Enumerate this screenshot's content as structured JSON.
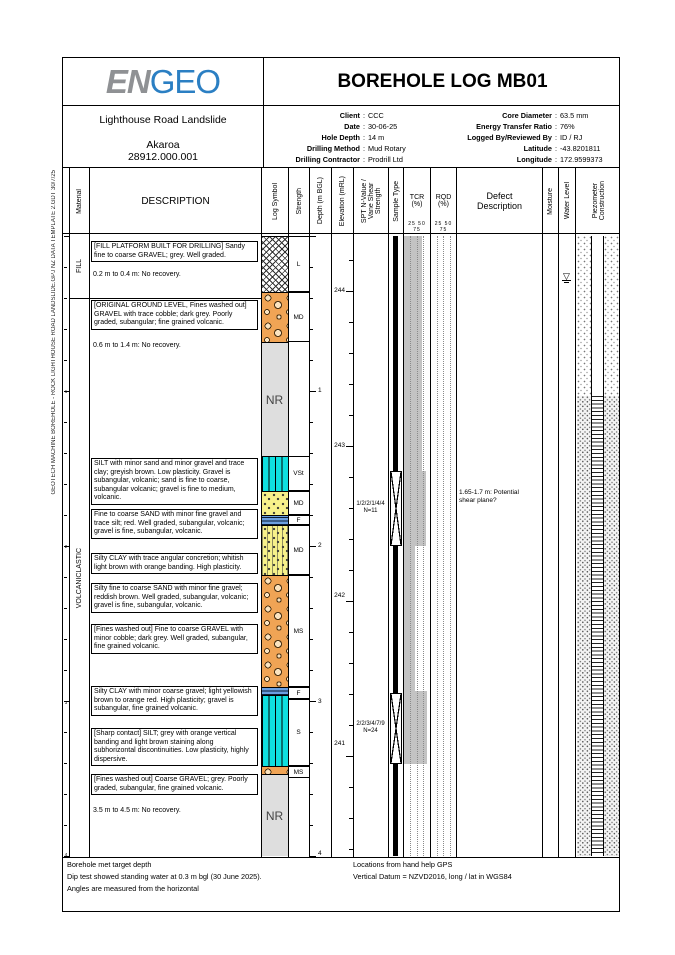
{
  "side_text": "GEOTECH MACHINE BOREHOLE - ROCK  LIGHTHOUSE ROAD LANDSLIDE.GPJ  NZ DATA TEMPLATE 2.GDT  30/7/25",
  "header": {
    "logo_part1": "EN",
    "logo_part2": "GEO",
    "title": "BOREHOLE LOG MB01",
    "project_name": "Lighthouse Road Landslide",
    "project_location": "Akaroa",
    "project_number": "28912.000.001",
    "info_left": [
      {
        "label": "Client",
        "value": "CCC"
      },
      {
        "label": "Date",
        "value": "30-06-25"
      },
      {
        "label": "Hole Depth",
        "value": "14 m"
      },
      {
        "label": "Drilling Method",
        "value": "Mud Rotary"
      },
      {
        "label": "Drilling Contractor",
        "value": "Prodrill Ltd"
      }
    ],
    "info_right": [
      {
        "label": "Core Diameter",
        "value": "63.5 mm"
      },
      {
        "label": "Energy Transfer Ratio",
        "value": "76%"
      },
      {
        "label": "Logged By/Reviewed By",
        "value": "ID / RJ"
      },
      {
        "label": "Latitude",
        "value": "-43.8201811"
      },
      {
        "label": "Longitude",
        "value": "172.9599373"
      }
    ]
  },
  "columns": [
    {
      "key": "ruler",
      "x": 0,
      "w": 6,
      "label": "",
      "vert": false
    },
    {
      "key": "material",
      "x": 6,
      "w": 20,
      "label": "Material",
      "vert": true
    },
    {
      "key": "description",
      "x": 26,
      "w": 172,
      "label": "DESCRIPTION",
      "vert": false,
      "big": true
    },
    {
      "key": "log-symbol",
      "x": 198,
      "w": 27,
      "label": "Log Symbol",
      "vert": true
    },
    {
      "key": "strength",
      "x": 225,
      "w": 21,
      "label": "Strength",
      "vert": true
    },
    {
      "key": "depth",
      "x": 246,
      "w": 22,
      "label": "Depth (m BGL)",
      "vert": true
    },
    {
      "key": "elevation",
      "x": 268,
      "w": 22,
      "label": "Elevation (mRL)",
      "vert": true
    },
    {
      "key": "spt",
      "x": 290,
      "w": 35,
      "label": "SPT N-Value /\nVane Shear\nStrength",
      "vert": true
    },
    {
      "key": "sample-type",
      "x": 325,
      "w": 15,
      "label": "Sample Type",
      "vert": true
    },
    {
      "key": "tcr",
      "x": 340,
      "w": 27,
      "label": "TCR\n(%)",
      "vert": false,
      "scale": true
    },
    {
      "key": "rqd",
      "x": 367,
      "w": 26,
      "label": "RQD\n(%)",
      "vert": false,
      "scale": true
    },
    {
      "key": "defect",
      "x": 393,
      "w": 86,
      "label": "Defect\nDescription",
      "vert": false,
      "big": true
    },
    {
      "key": "moisture",
      "x": 479,
      "w": 16,
      "label": "Moisture",
      "vert": true
    },
    {
      "key": "water-level",
      "x": 495,
      "w": 17,
      "label": "Water Level",
      "vert": true
    },
    {
      "key": "piezometer",
      "x": 512,
      "w": 46,
      "label": "Piezometer\nConstruction",
      "vert": true
    }
  ],
  "scale_ticks": "25 50 75",
  "log": {
    "materials": [
      {
        "label": "FILL",
        "top": 0,
        "height": 64
      },
      {
        "label": "VOLCANICLASTIC",
        "top": 64,
        "height": 560
      }
    ],
    "material_divider_y": 64,
    "descriptions": [
      {
        "top": 7,
        "boxed": true,
        "text": "[FILL PLATFORM BUILT FOR DRILLING] Sandy fine to coarse GRAVEL; grey. Well graded."
      },
      {
        "top": 36,
        "boxed": false,
        "text": "0.2 m to 0.4 m: No recovery."
      },
      {
        "top": 66,
        "boxed": true,
        "text": "[ORIGINAL GROUND LEVEL, Fines washed out] GRAVEL with trace cobble; dark grey. Poorly graded, subangular; fine grained volcanic."
      },
      {
        "top": 107,
        "boxed": false,
        "text": "0.6 m to 1.4 m: No recovery."
      },
      {
        "top": 224,
        "boxed": true,
        "text": "SILT with minor sand and minor gravel and trace clay; greyish brown. Low plasticity. Gravel is subangular, volcanic; sand is fine to coarse, subangular volcanic; gravel is fine to medium, volcanic."
      },
      {
        "top": 275,
        "boxed": true,
        "text": "Fine to coarse SAND with minor fine gravel and trace silt; red. Well graded, subangular, volcanic; gravel is fine, subangular, volcanic."
      },
      {
        "top": 319,
        "boxed": true,
        "text": "Silty CLAY with trace angular concretion; whitish light brown with orange banding. High plasticity."
      },
      {
        "top": 349,
        "boxed": true,
        "text": "Silty fine to coarse SAND with minor fine gravel; reddish brown. Well graded, subangular, volcanic; gravel is fine, subangular, volcanic."
      },
      {
        "top": 390,
        "boxed": true,
        "text": "[Fines washed out] Fine to coarse GRAVEL with minor cobble; dark grey. Well graded, subangular, fine grained volcanic."
      },
      {
        "top": 452,
        "boxed": true,
        "text": "Silty CLAY with minor coarse gravel; light yellowish brown to orange red. High plasticity; gravel is subangular, fine grained volcanic."
      },
      {
        "top": 494,
        "boxed": true,
        "text": "[Sharp contact] SILT; grey with orange vertical banding and light brown staining along subhorizontal discontinuities. Low plasticity, highly dispersive."
      },
      {
        "top": 540,
        "boxed": true,
        "text": "[Fines washed out] Coarse GRAVEL; grey. Poorly graded, subangular, fine grained volcanic."
      },
      {
        "top": 572,
        "boxed": false,
        "text": "3.5 m to 4.5 m: No recovery."
      }
    ],
    "segments": [
      {
        "top": 2,
        "h": 56,
        "pattern": "hatch"
      },
      {
        "top": 58,
        "h": 50,
        "pattern": "gravel"
      },
      {
        "top": 108,
        "h": 114,
        "pattern": "nr",
        "label": "NR"
      },
      {
        "top": 222,
        "h": 35,
        "pattern": "silt"
      },
      {
        "top": 257,
        "h": 24,
        "pattern": "sand"
      },
      {
        "top": 281,
        "h": 10,
        "pattern": "clay"
      },
      {
        "top": 291,
        "h": 50,
        "pattern": "sand-silty"
      },
      {
        "top": 341,
        "h": 112,
        "pattern": "gravel"
      },
      {
        "top": 453,
        "h": 8,
        "pattern": "clay"
      },
      {
        "top": 461,
        "h": 71,
        "pattern": "silt"
      },
      {
        "top": 532,
        "h": 8,
        "pattern": "gravel"
      },
      {
        "top": 540,
        "h": 82,
        "pattern": "nr",
        "label": "NR"
      }
    ],
    "strength_cells": [
      {
        "top": 2,
        "h": 56,
        "label": "L"
      },
      {
        "top": 58,
        "h": 50,
        "label": "MD"
      },
      {
        "top": 222,
        "h": 35,
        "label": "VSt"
      },
      {
        "top": 257,
        "h": 24,
        "label": "MD"
      },
      {
        "top": 281,
        "h": 10,
        "label": "F"
      },
      {
        "top": 291,
        "h": 50,
        "label": "MD"
      },
      {
        "top": 341,
        "h": 112,
        "label": "MS"
      },
      {
        "top": 453,
        "h": 12,
        "label": "F"
      },
      {
        "top": 465,
        "h": 67,
        "label": "S"
      },
      {
        "top": 532,
        "h": 12,
        "label": "MS"
      }
    ],
    "depth_labels": [
      {
        "value": "1",
        "y": 157
      },
      {
        "value": "2",
        "y": 312
      },
      {
        "value": "3",
        "y": 468
      },
      {
        "value": "4",
        "y": 620
      }
    ],
    "elev_labels": [
      {
        "value": "244",
        "y": 57
      },
      {
        "value": "243",
        "y": 212
      },
      {
        "value": "242",
        "y": 362
      },
      {
        "value": "241",
        "y": 510
      }
    ],
    "spt_tests": [
      {
        "top": 237,
        "h": 75,
        "blows": "1/2/2/1/4/4",
        "n": "N=11"
      },
      {
        "top": 459,
        "h": 71,
        "blows": "2/2/3/4/7/9",
        "n": "N=24"
      }
    ],
    "sample_bar": {
      "top": 2,
      "h": 620
    },
    "tcr_bars": [
      {
        "top": 2,
        "h": 235,
        "frac": 0.7
      },
      {
        "top": 237,
        "h": 75,
        "frac": 0.85
      },
      {
        "top": 312,
        "h": 145,
        "frac": 0.45
      },
      {
        "top": 457,
        "h": 73,
        "frac": 0.9
      }
    ],
    "defects": [
      {
        "top": 255,
        "text": "1.65-1.7 m: Potential shear plane?"
      }
    ],
    "water_level_y": 38,
    "piezo": {
      "top": 2,
      "transition_y": 162,
      "bottom": 622
    }
  },
  "footer": {
    "left": [
      "Borehole met target depth",
      "Dip test showed standing water at 0.3 m bgl (30 June 2025).",
      "Angles are measured from the horizontal"
    ],
    "right": [
      "Locations from hand help GPS",
      "Vertical Datum = NZVD2016, long / lat in WGS84"
    ]
  }
}
